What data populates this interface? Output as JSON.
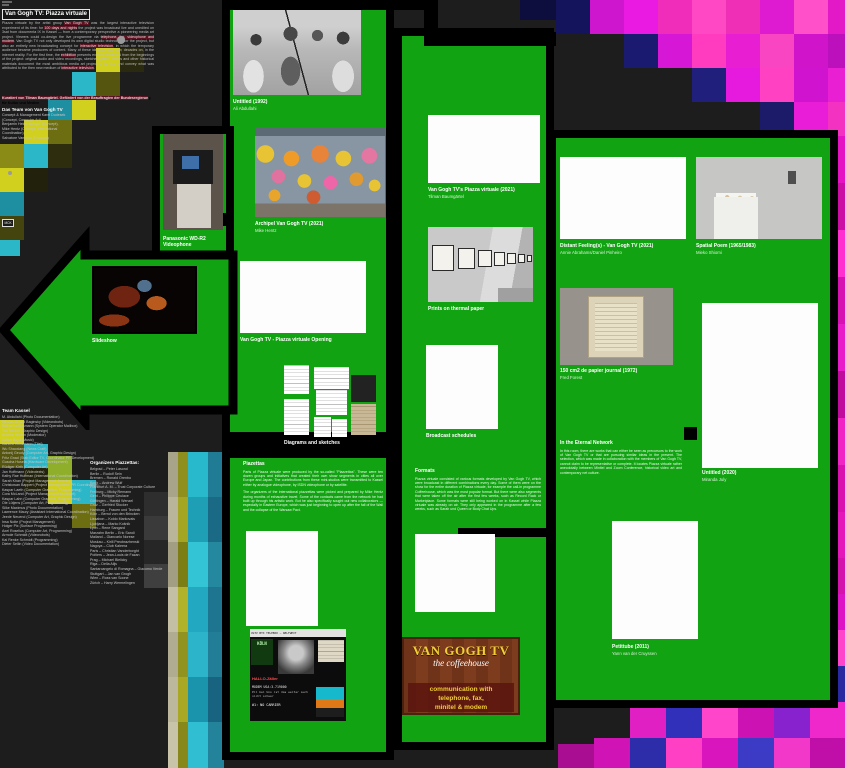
{
  "meta": {
    "accent_colors": {
      "floor_green": "#12a312",
      "mosaic_magenta": "#e817c7",
      "mosaic_yellow": "#d2d01e",
      "mosaic_cyan": "#2bb7c8",
      "highlight_maroon": "#5c1220"
    }
  },
  "intro": {
    "title": "Van Gogh TV: Piazza virtuale",
    "paragraph": [
      [
        "Piazza virtuale by the artist group "
      ],
      [
        "Van Gogh TV",
        1
      ],
      [
        " was the largest interactive television experiment of its time: for "
      ],
      [
        "100 days and nights",
        1
      ],
      [
        " the project was broadcast live and unedited on 3sat from documenta IX in Kassel — from a contemporary perspective a pioneering media art project. Viewers could co-design the live programme via "
      ],
      [
        "telephone, fax, videophone and modem",
        1
      ],
      [
        ". Van Gogh TV not only developed its own digital studio technology for the project, but also an entirely new broadcasting concept for "
      ],
      [
        "interactive television",
        1
      ],
      [
        ", in which the temporary audience became producers of content. Many of these ideas we see now, decades on, in the internet reality. For the first time, the "
      ],
      [
        "exhibition",
        1
      ],
      [
        " presents extensive material from the beginnings of the project: original audio and video recordings, sketches, plans, photos and other historical materials document the most ambitious media art project of its time and convey what was attributed to the then new medium of "
      ],
      [
        "interactive television",
        1
      ],
      [
        "."
      ]
    ],
    "funding": [
      [
        "Kuratiert von Tilman Baumgärtel. Gefördert von der Beauftragten der Bundesregierun",
        1
      ],
      [
        "g für Kultur und Medien"
      ]
    ],
    "team_header": "Das Team von Van Gogh TV",
    "team_lines": [
      "Concept & Management Karel Dudesek",
      "(Concept, Computer Art),",
      "Benjamin Heidersberger (Concept),",
      "Mike Hentz (Concept, International",
      "Coordination),",
      "Salvatore Vanasco (Concept)"
    ],
    "badge": "MCK"
  },
  "team_kassel": {
    "header": "Team Kassel",
    "members": [
      "M. Abdullahi (Photo Documentation)",
      "Nicolas-Anatol Baginsky (Videorobots)",
      "Katharina Busmann (System Operator Mailbox)",
      "Tim Becker (Graphic Design)",
      "Anselm Bilvern (Moderator)",
      "Johan Boyd (Music)",
      "Karlene Brinkmann (Titel)",
      "Wu Shaoxiang (News Craft)",
      "Antonij Geudy (Computer Art, Graphic Design)",
      "Fritz Gnad (Stab Editor TV, Coordinator PR Development)",
      "Guscha Husela (Hardware Development)",
      "Rüdiger Kirth (Computer Art)",
      "Jan Hoffmann (Videotexts)",
      "Kathy Rae Huffman (International Coordination)",
      "Sarah Khan (Project Management America)",
      "Christowan Bappert (Project Management, PR Coordination)",
      "Kaspar Laeth (Computer Graphics, Programming)",
      "Cora McLand (Project Management Assistant)",
      "Kaspar Lahn (Computer Graphics, Programming)",
      "Ole Lütjens (Computer Art, Programming)",
      "Silke Maximus (Photo Documentation)",
      "Lawrence Maury (Assistant International Coordination)",
      "Jeede Neuend (Computer Art, Graphic Design)",
      "Insa Nolte (Project Management)",
      "Holger Pix (Surface Programming)",
      "Axel Roselius (Computer Art, Programming)",
      "Armole Schmidt (Videorobots)",
      "Kai Renke Schmidt (Programming)",
      "Dieter Sellin (Video Documentation)"
    ]
  },
  "organizers": {
    "header": "Organizers Piazzettas:",
    "entries": [
      "Belgrad – Peter Lasond",
      "Berlin – Rudolf Sein",
      "Bremen – Ronald Orenbo",
      "Koch – Andrew Wulf",
      "Frankfurt A. M. – Trust Corporate Culture",
      "Freiburg – Micky Remann",
      "Gent – Philippe Ceulace",
      "Göttingen – Harald Wenzel",
      "Graz – Gerfried Stocker",
      "Hamburg – Frauen und Technik",
      "Köln – Bernd von den Brincken",
      "Lissabon – Koldo Markovais",
      "Ljubljana – Marko Košnik",
      "Lyon – Rene Sangard",
      "Marzahn Berlin – Eric Sandi",
      "Mailand – Giancarlo Norese",
      "Moskau – Kirill Preobrazhenski",
      "Nagoya – Club Kaleera",
      "Paris – Christian Vanderborght",
      "Poitiers – Jean-Louis de Fazan",
      "Prag – Michael Bielicky",
      "Riga – Della Alijs",
      "Santarcangelo di Romagna – Giacomo Verde",
      "Stuttgart – Jan van Grogh",
      "Wien – Ross van Soone",
      "Zürich – Harry Wermelingen"
    ]
  },
  "items": {
    "untitled1992": {
      "title": "Untitled (1992)",
      "artist": "Ali Abdullahi"
    },
    "panasonic": {
      "title": "Panasonic WD-R2",
      "title2": "Videophone"
    },
    "archipel": {
      "title": "Archipel Van Gogh TV (2021)",
      "artist": "Mike Hentz"
    },
    "book": {
      "title": "Van Gogh TV's Piazza virtuale (2021)",
      "artist": "Tilman Baumgärtel"
    },
    "slideshow": {
      "title": "Slideshow"
    },
    "opening": {
      "title": "Van Gogh TV - Piazza virtuale Opening"
    },
    "thermal": {
      "title": "Prints on thermal paper"
    },
    "diagrams": {
      "title": "Diagrams and sketches"
    },
    "schedules": {
      "title": "Broadcast schedules"
    },
    "distant": {
      "title": "Distant Feeling(s) - Van Gogh TV (2021)",
      "artist": "Annie Abrahams/Daniel Pinheiro"
    },
    "spatial": {
      "title": "Spatial Poem (1965/1983)",
      "artist": "Mieko Shiomi"
    },
    "forest": {
      "title": "150 cm2 de papier journal (1972)",
      "artist": "Fred Forest"
    },
    "july": {
      "title": "Untitled (2020)",
      "artist": "Miranda July"
    },
    "petittube": {
      "title": "Petittube (2011)",
      "artist": "Yann van der Cruyssen"
    }
  },
  "texts": {
    "piazettas": {
      "header": "Piazettas",
      "p1": "Parts of Piazza virtuale were produced by the so-called \"Piazzettas\". These were ten dozen groups and initiatives that created their own show segments in cities all over Europe and Japan. The contributions from these mini-studios were transmitted to Kassel either by analogue videophone, by ISDN videophone or by satellite.",
      "p2": "The organizers of the international piazzettas were picked and prepared by Mike Hentz during months of exhaustive travel. Some of the contacts came from the network he had built up through his artistic work. But he also specifically sought out new collaborators — especially in Eastern Europe, which was just beginning to open up after the fall of the Wall and the collapse of the Warsaw Pact."
    },
    "formats": {
      "header": "Formats",
      "p1": "Piazza virtuale consisted of various formats developed by Van Gogh TV, which were broadcast in different combinations every day. Some of them were on the show for the entire duration of Piazza virtuale, for example the call-in programme Coffeehouse, which was the most popular format. But there were also segments that were taken off the air after the first few weeks, such as Record Rack or Marketplace. Some formats were still being worked on in Kassel while Piazza virtuale was already on air. They only appeared in the programme after a few weeks, such as Sarah und Queen or Body Chat Ups."
    },
    "eternal": {
      "header": "In the Eternal Network",
      "p1": "In this room, there are works that can either be seen as precursors to the work of Van Gogh TV or that are pursuing similar ideas in the present. The selection, which was made in collaboration with the members of Van Gogh TV, cannot claim to be representative or complete. It locates Piazza virtuale rather anecdotally between Minitel and Zoom Conference, historical video art and contemporary net culture."
    }
  },
  "posters": {
    "coffeehouse": {
      "line1": "VAN GOGH TV",
      "line2": "the coffeehouse",
      "line3": "communication with",
      "line4": "telephone, fax,",
      "line5": "minitel & modem"
    },
    "collage": {
      "top": "VGTV BTX TELEBOX — WELTWEIT",
      "city": "KÖLN",
      "hallo": "HALLO-Zäller",
      "modem": "MODEM USA:3-719000",
      "line": "Pil bei Uns ist das weiter auch nicht schwer",
      "carrier": "#1: NO CARRIER"
    }
  },
  "decor": {
    "cells": [
      [
        120,
        48,
        24,
        24,
        "#2a2a10"
      ],
      [
        96,
        48,
        24,
        24,
        "#d2d01e"
      ],
      [
        96,
        72,
        24,
        24,
        "#55550f"
      ],
      [
        72,
        72,
        24,
        24,
        "#2bb7c8"
      ],
      [
        72,
        96,
        24,
        24,
        "#d2d01e"
      ],
      [
        48,
        96,
        24,
        24,
        "#1e8fa0"
      ],
      [
        48,
        120,
        24,
        24,
        "#6d6d12"
      ],
      [
        24,
        120,
        24,
        24,
        "#d2d01e"
      ],
      [
        24,
        144,
        24,
        24,
        "#2bb7c8"
      ],
      [
        0,
        144,
        24,
        24,
        "#8a8a16"
      ],
      [
        0,
        168,
        24,
        24,
        "#d2d01e"
      ],
      [
        24,
        168,
        24,
        24,
        "#22220c"
      ],
      [
        48,
        144,
        24,
        24,
        "#2e2e0e"
      ],
      [
        0,
        192,
        24,
        24,
        "#1e8fa0"
      ],
      [
        0,
        216,
        24,
        24,
        "#44440e"
      ],
      [
        0,
        240,
        20,
        16,
        "#2bb7c8"
      ],
      [
        0,
        420,
        24,
        24,
        "#d2d01e"
      ],
      [
        0,
        444,
        24,
        24,
        "#55550f"
      ],
      [
        24,
        444,
        24,
        24,
        "#2bb7c8"
      ],
      [
        48,
        456,
        24,
        24,
        "#8fae2a"
      ],
      [
        24,
        468,
        24,
        24,
        "#23230d"
      ],
      [
        48,
        480,
        24,
        24,
        "#d2d01e"
      ],
      [
        72,
        480,
        24,
        24,
        "#2bb7c8"
      ],
      [
        72,
        504,
        24,
        24,
        "#6d6d12"
      ],
      [
        96,
        480,
        24,
        24,
        "#262626"
      ],
      [
        144,
        492,
        24,
        24,
        "#2e2e2e"
      ],
      [
        144,
        516,
        24,
        24,
        "#3a3a3a"
      ],
      [
        144,
        540,
        24,
        24,
        "#262626"
      ],
      [
        144,
        564,
        24,
        24,
        "#3f3f3f"
      ],
      [
        168,
        452,
        10,
        45,
        "#a8a48a"
      ],
      [
        168,
        497,
        10,
        45,
        "#b9b59b"
      ],
      [
        168,
        542,
        10,
        45,
        "#a29e84"
      ],
      [
        168,
        587,
        10,
        45,
        "#c3bfa5"
      ],
      [
        168,
        632,
        10,
        45,
        "#b0ac92"
      ],
      [
        168,
        677,
        10,
        45,
        "#bcb89e"
      ],
      [
        168,
        722,
        10,
        46,
        "#c8c4aa"
      ],
      [
        178,
        452,
        10,
        45,
        "#8f8f1e"
      ],
      [
        178,
        497,
        10,
        45,
        "#a5a524"
      ],
      [
        178,
        542,
        10,
        45,
        "#7d7d16"
      ],
      [
        178,
        587,
        10,
        45,
        "#b1b12a"
      ],
      [
        178,
        632,
        10,
        45,
        "#929220"
      ],
      [
        178,
        677,
        10,
        45,
        "#a8a824"
      ],
      [
        178,
        722,
        10,
        46,
        "#88881a"
      ],
      [
        188,
        452,
        20,
        45,
        "#29b9cc"
      ],
      [
        188,
        497,
        20,
        45,
        "#1f9fb6"
      ],
      [
        188,
        542,
        20,
        45,
        "#33c4d6"
      ],
      [
        188,
        587,
        20,
        45,
        "#22a8c0"
      ],
      [
        188,
        632,
        20,
        45,
        "#2cb5ca"
      ],
      [
        188,
        677,
        20,
        45,
        "#1a93ac"
      ],
      [
        188,
        722,
        20,
        46,
        "#30bed2"
      ],
      [
        208,
        452,
        16,
        45,
        "#207c94"
      ],
      [
        208,
        497,
        16,
        45,
        "#1a6a86"
      ],
      [
        208,
        542,
        16,
        45,
        "#24889e"
      ],
      [
        208,
        587,
        16,
        45,
        "#1d7590"
      ],
      [
        208,
        632,
        16,
        45,
        "#217e96"
      ],
      [
        208,
        677,
        16,
        45,
        "#186480"
      ],
      [
        208,
        722,
        16,
        46,
        "#22839a"
      ],
      [
        520,
        0,
        36,
        20,
        "#0e0e3e"
      ],
      [
        556,
        0,
        34,
        34,
        "#14145c"
      ],
      [
        590,
        0,
        34,
        34,
        "#cf16cf"
      ],
      [
        624,
        0,
        34,
        34,
        "#ea1ae2"
      ],
      [
        658,
        0,
        34,
        34,
        "#f02cbb"
      ],
      [
        692,
        0,
        34,
        34,
        "#ff49c4"
      ],
      [
        726,
        0,
        34,
        34,
        "#ef2fb5"
      ],
      [
        760,
        0,
        34,
        34,
        "#de1bd0"
      ],
      [
        794,
        0,
        34,
        34,
        "#ff4fc9"
      ],
      [
        828,
        0,
        17,
        34,
        "#e318c6"
      ],
      [
        624,
        34,
        34,
        34,
        "#1a1a70"
      ],
      [
        658,
        34,
        34,
        34,
        "#d617d6"
      ],
      [
        692,
        34,
        34,
        34,
        "#ff3cc0"
      ],
      [
        726,
        34,
        34,
        34,
        "#e81ed2"
      ],
      [
        760,
        34,
        34,
        34,
        "#f945c2"
      ],
      [
        794,
        34,
        34,
        34,
        "#cf14c9"
      ],
      [
        828,
        34,
        17,
        34,
        "#bb10bb"
      ],
      [
        692,
        68,
        34,
        34,
        "#20207c"
      ],
      [
        726,
        68,
        34,
        34,
        "#e619de"
      ],
      [
        760,
        68,
        34,
        34,
        "#ff41c2"
      ],
      [
        794,
        68,
        34,
        34,
        "#d013cf"
      ],
      [
        828,
        68,
        17,
        34,
        "#e81fd3"
      ],
      [
        760,
        102,
        34,
        34,
        "#1b1b6a"
      ],
      [
        794,
        102,
        34,
        34,
        "#e91cd7"
      ],
      [
        828,
        102,
        17,
        34,
        "#f332c2"
      ],
      [
        836,
        136,
        9,
        47,
        "#e414c4"
      ],
      [
        836,
        183,
        9,
        47,
        "#cb0fa4"
      ],
      [
        836,
        230,
        9,
        47,
        "#ff2fd0"
      ],
      [
        836,
        277,
        9,
        47,
        "#d612b2"
      ],
      [
        836,
        324,
        9,
        47,
        "#e81cc8"
      ],
      [
        836,
        371,
        9,
        47,
        "#c00c9c"
      ],
      [
        836,
        418,
        9,
        47,
        "#f024c4"
      ],
      [
        836,
        465,
        9,
        47,
        "#d911ae"
      ],
      [
        836,
        512,
        9,
        47,
        "#e417bb"
      ],
      [
        774,
        558,
        36,
        36,
        "#e518b7"
      ],
      [
        810,
        558,
        35,
        36,
        "#d412ac"
      ],
      [
        738,
        594,
        36,
        36,
        "#2a2ab2"
      ],
      [
        774,
        594,
        36,
        36,
        "#ff3ec8"
      ],
      [
        810,
        594,
        35,
        36,
        "#dd14c6"
      ],
      [
        702,
        630,
        36,
        36,
        "#8a22c8"
      ],
      [
        738,
        630,
        36,
        36,
        "#ee1fd2"
      ],
      [
        774,
        630,
        36,
        36,
        "#3333c2"
      ],
      [
        810,
        630,
        35,
        36,
        "#ff44cc"
      ],
      [
        666,
        666,
        36,
        36,
        "#d315b7"
      ],
      [
        702,
        666,
        36,
        36,
        "#ff3bc1"
      ],
      [
        738,
        666,
        36,
        36,
        "#6a1bb2"
      ],
      [
        774,
        666,
        36,
        36,
        "#e21cce"
      ],
      [
        810,
        666,
        35,
        36,
        "#2a2aa0"
      ],
      [
        630,
        702,
        36,
        36,
        "#e020c2"
      ],
      [
        666,
        702,
        36,
        36,
        "#3030ba"
      ],
      [
        702,
        702,
        36,
        36,
        "#ff46ca"
      ],
      [
        738,
        702,
        36,
        36,
        "#cc12b2"
      ],
      [
        774,
        702,
        36,
        36,
        "#8822ce"
      ],
      [
        810,
        702,
        35,
        36,
        "#ee28ca"
      ],
      [
        594,
        738,
        36,
        30,
        "#cf13b5"
      ],
      [
        630,
        738,
        36,
        30,
        "#2d2daa"
      ],
      [
        666,
        738,
        36,
        30,
        "#ff3fc4"
      ],
      [
        702,
        738,
        36,
        30,
        "#d916be"
      ],
      [
        738,
        738,
        36,
        30,
        "#3b3bc6"
      ],
      [
        774,
        738,
        36,
        30,
        "#f138c8"
      ],
      [
        810,
        738,
        35,
        30,
        "#c00fa8"
      ],
      [
        558,
        744,
        36,
        24,
        "#a80d92"
      ]
    ]
  }
}
